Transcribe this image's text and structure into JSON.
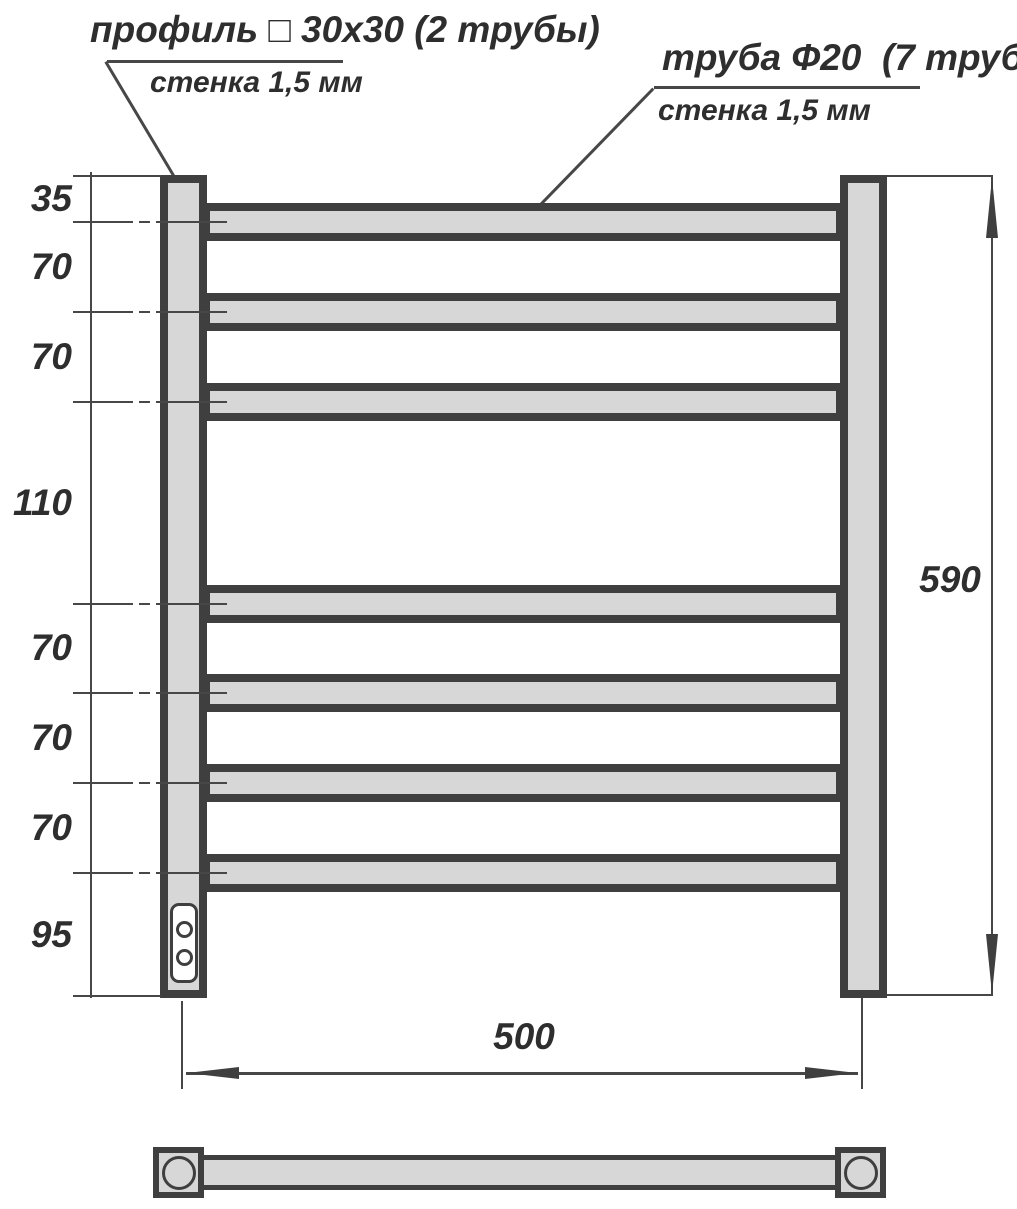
{
  "drawing": {
    "type": "towel-rail-dimension-drawing",
    "callouts": {
      "profile": {
        "title": "профиль □ 30х30 (2 трубы)",
        "wall": "стенка 1,5 мм"
      },
      "tube": {
        "title": "труба Ф20  (7 труб)",
        "wall": "стенка 1,5 мм"
      }
    },
    "dimensions": {
      "left_chain": [
        "35",
        "70",
        "70",
        "110",
        "70",
        "70",
        "70",
        "95"
      ],
      "overall_height": "590",
      "center_distance": "500"
    },
    "colors": {
      "outline": "#3f3f3f",
      "fill": "#d7d7d7",
      "background": "#ffffff",
      "text": "#2e2e2e"
    }
  }
}
